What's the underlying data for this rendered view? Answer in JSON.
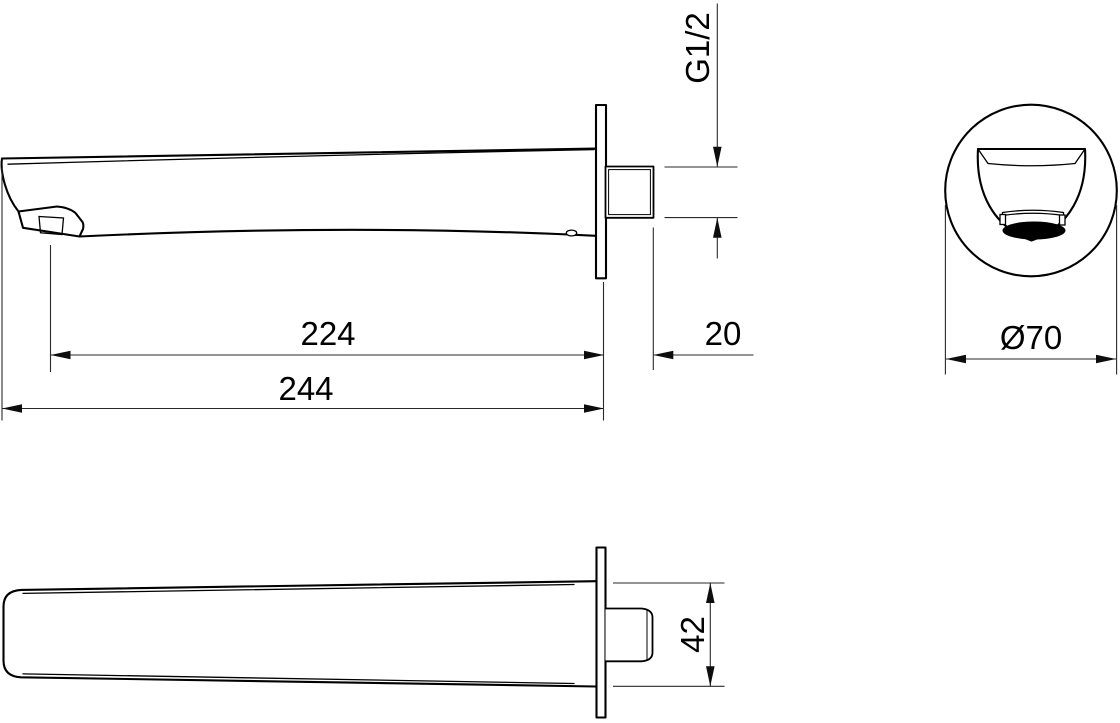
{
  "drawing": {
    "background_color": "#ffffff",
    "line_color": "#000000",
    "labels": {
      "overall_length": "244",
      "spout_reach": "224",
      "connector_length": "20",
      "thread_size": "G1/2",
      "flange_diameter": "Ø70",
      "body_width": "42"
    }
  }
}
